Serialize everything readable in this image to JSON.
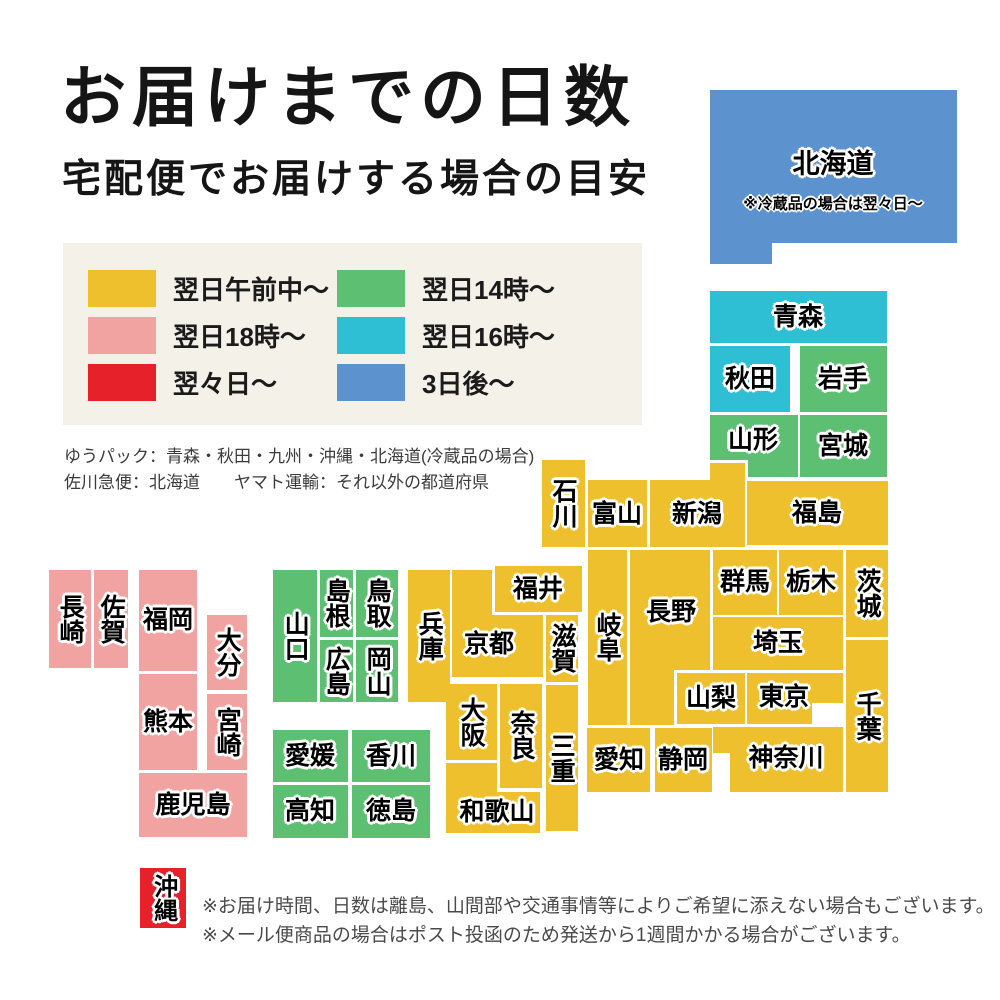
{
  "title": "お届けまでの日数",
  "subtitle": "宅配便でお届けする場合の目安",
  "legend": {
    "items": [
      {
        "label": "翌日午前中〜",
        "color": "yellow"
      },
      {
        "label": "翌日18時〜",
        "color": "pink"
      },
      {
        "label": "翌々日〜",
        "color": "red"
      },
      {
        "label": "翌日14時〜",
        "color": "green"
      },
      {
        "label": "翌日16時〜",
        "color": "cyan"
      },
      {
        "label": "3日後〜",
        "color": "blue"
      }
    ]
  },
  "carrier_notes": [
    "ゆうパック：青森・秋田・九州・沖縄・北海道(冷蔵品の場合)",
    "佐川急便：北海道　　ヤマト運輸：それ以外の都道府県"
  ],
  "footer": {
    "notes": [
      "※お届け時間、日数は離島、山間部や交通事情等によりご希望に添えない場合もございます。",
      "※メール便商品の場合はポスト投函のため発送から1週間かかる場合がございます。"
    ]
  },
  "map": {
    "palette": {
      "yellow": "#efc02e",
      "pink": "#f0a3a0",
      "red": "#e62129",
      "green": "#5cbf72",
      "cyan": "#2ebfd5",
      "blue": "#5c93cf"
    },
    "prefectures": [
      {
        "id": "hokkaido",
        "name": "北海道",
        "color": "blue",
        "fs": 27,
        "label": [
          833,
          164
        ],
        "rects": [
          [
            710,
            90,
            247,
            153
          ],
          [
            710,
            243,
            62,
            21
          ]
        ],
        "note": {
          "text": "※冷蔵品の場合は翌々日〜",
          "cx": 833,
          "cy": 203
        }
      },
      {
        "id": "aomori",
        "name": "青森",
        "color": "cyan",
        "label": [
          798,
          317
        ],
        "rects": [
          [
            710,
            291,
            177,
            52
          ]
        ]
      },
      {
        "id": "akita",
        "name": "秋田",
        "color": "cyan",
        "label": [
          750,
          379
        ],
        "rects": [
          [
            710,
            346,
            80,
            66
          ]
        ]
      },
      {
        "id": "iwate",
        "name": "岩手",
        "color": "green",
        "label": [
          843,
          379
        ],
        "rects": [
          [
            800,
            346,
            87,
            66
          ]
        ]
      },
      {
        "id": "yamagata",
        "name": "山形",
        "color": "green",
        "label": [
          753,
          440
        ],
        "rects": [
          [
            710,
            415,
            88,
            45
          ],
          [
            748,
            460,
            50,
            17
          ]
        ]
      },
      {
        "id": "miyagi",
        "name": "宮城",
        "color": "green",
        "label": [
          843,
          446
        ],
        "rects": [
          [
            800,
            415,
            87,
            62
          ]
        ]
      },
      {
        "id": "fukushima",
        "name": "福島",
        "color": "yellow",
        "label": [
          817,
          513
        ],
        "rects": [
          [
            747,
            481,
            141,
            64
          ]
        ]
      },
      {
        "id": "niigata",
        "name": "新潟",
        "color": "yellow",
        "label": [
          697,
          514
        ],
        "rects": [
          [
            650,
            480,
            95,
            67
          ],
          [
            710,
            463,
            35,
            17
          ]
        ]
      },
      {
        "id": "toyama",
        "name": "富山",
        "color": "yellow",
        "label": [
          617,
          514
        ],
        "rects": [
          [
            588,
            480,
            59,
            67
          ]
        ]
      },
      {
        "id": "ishikawa",
        "name": "石川",
        "color": "yellow",
        "v": true,
        "label": [
          563,
          503
        ],
        "rects": [
          [
            542,
            460,
            43,
            87
          ]
        ]
      },
      {
        "id": "gunma",
        "name": "群馬",
        "color": "yellow",
        "label": [
          745,
          582
        ],
        "rects": [
          [
            713,
            550,
            64,
            65
          ]
        ]
      },
      {
        "id": "tochigi",
        "name": "栃木",
        "color": "yellow",
        "label": [
          811,
          582
        ],
        "rects": [
          [
            779,
            550,
            64,
            65
          ]
        ]
      },
      {
        "id": "ibaraki",
        "name": "茨城",
        "color": "yellow",
        "v": true,
        "label": [
          867,
          593
        ],
        "rects": [
          [
            846,
            550,
            42,
            87
          ]
        ]
      },
      {
        "id": "saitama",
        "name": "埼玉",
        "color": "yellow",
        "label": [
          778,
          643
        ],
        "rects": [
          [
            713,
            617,
            130,
            53
          ]
        ]
      },
      {
        "id": "nagano",
        "name": "長野",
        "color": "yellow",
        "label": [
          671,
          612
        ],
        "rects": [
          [
            630,
            550,
            80,
            120
          ],
          [
            630,
            670,
            44,
            55
          ]
        ]
      },
      {
        "id": "gifu",
        "name": "岐阜",
        "color": "yellow",
        "v": true,
        "label": [
          607,
          637
        ],
        "rects": [
          [
            588,
            550,
            39,
            175
          ]
        ]
      },
      {
        "id": "yamanashi",
        "name": "山梨",
        "color": "yellow",
        "label": [
          711,
          698
        ],
        "rects": [
          [
            677,
            673,
            68,
            51
          ]
        ]
      },
      {
        "id": "tokyo",
        "name": "東京",
        "color": "yellow",
        "label": [
          784,
          697
        ],
        "rects": [
          [
            747,
            673,
            96,
            30
          ],
          [
            747,
            703,
            65,
            21
          ]
        ]
      },
      {
        "id": "chiba",
        "name": "千葉",
        "color": "yellow",
        "v": true,
        "label": [
          867,
          716
        ],
        "rects": [
          [
            846,
            640,
            42,
            152
          ]
        ]
      },
      {
        "id": "kanagawa",
        "name": "神奈川",
        "color": "yellow",
        "label": [
          786,
          758
        ],
        "rects": [
          [
            713,
            727,
            130,
            26
          ],
          [
            730,
            753,
            113,
            39
          ]
        ]
      },
      {
        "id": "shizuoka",
        "name": "静岡",
        "color": "yellow",
        "label": [
          683,
          760
        ],
        "rects": [
          [
            655,
            728,
            57,
            64
          ]
        ]
      },
      {
        "id": "aichi",
        "name": "愛知",
        "color": "yellow",
        "label": [
          619,
          760
        ],
        "rects": [
          [
            587,
            728,
            63,
            64
          ]
        ]
      },
      {
        "id": "kyoto",
        "name": "京都",
        "color": "yellow",
        "label": [
          489,
          644
        ],
        "rects": [
          [
            452,
            570,
            91,
            107
          ]
        ]
      },
      {
        "id": "fukui",
        "name": "福井",
        "color": "yellow",
        "ring": true,
        "label": [
          538,
          589
        ],
        "rects": [
          [
            495,
            566,
            87,
            46
          ]
        ]
      },
      {
        "id": "shiga",
        "name": "滋賀",
        "color": "yellow",
        "v": true,
        "label": [
          562,
          648
        ],
        "rects": [
          [
            546,
            615,
            32,
            67
          ]
        ]
      },
      {
        "id": "osaka",
        "name": "大阪",
        "color": "yellow",
        "v": true,
        "label": [
          471,
          722
        ],
        "rects": [
          [
            446,
            684,
            51,
            76
          ]
        ]
      },
      {
        "id": "nara",
        "name": "奈良",
        "color": "yellow",
        "v": true,
        "label": [
          521,
          735
        ],
        "rects": [
          [
            500,
            684,
            42,
            104
          ]
        ]
      },
      {
        "id": "mie",
        "name": "三重",
        "color": "yellow",
        "v": true,
        "label": [
          561,
          758
        ],
        "rects": [
          [
            546,
            685,
            32,
            146
          ]
        ]
      },
      {
        "id": "wakayama",
        "name": "和歌山",
        "color": "yellow",
        "label": [
          497,
          812
        ],
        "rects": [
          [
            446,
            763,
            51,
            70
          ],
          [
            497,
            792,
            43,
            41
          ]
        ]
      },
      {
        "id": "hyogo",
        "name": "兵庫",
        "color": "yellow",
        "v": true,
        "label": [
          429,
          636
        ],
        "rects": [
          [
            408,
            570,
            42,
            132
          ]
        ]
      },
      {
        "id": "tottori",
        "name": "鳥取",
        "color": "green",
        "v": true,
        "label": [
          377,
          603
        ],
        "rects": [
          [
            356,
            570,
            42,
            67
          ]
        ]
      },
      {
        "id": "okayama",
        "name": "岡山",
        "color": "green",
        "v": true,
        "label": [
          377,
          671
        ],
        "rects": [
          [
            356,
            640,
            42,
            62
          ]
        ]
      },
      {
        "id": "shimane",
        "name": "島根",
        "color": "green",
        "v": true,
        "label": [
          336,
          603
        ],
        "rects": [
          [
            320,
            570,
            33,
            67
          ]
        ]
      },
      {
        "id": "hiroshima",
        "name": "広島",
        "color": "green",
        "v": true,
        "label": [
          336,
          671
        ],
        "rects": [
          [
            320,
            640,
            33,
            62
          ]
        ]
      },
      {
        "id": "yamaguchi",
        "name": "山口",
        "color": "green",
        "v": true,
        "label": [
          295,
          636
        ],
        "rects": [
          [
            273,
            570,
            44,
            132
          ]
        ]
      },
      {
        "id": "ehime",
        "name": "愛媛",
        "color": "green",
        "label": [
          310,
          756
        ],
        "rects": [
          [
            273,
            730,
            75,
            52
          ]
        ]
      },
      {
        "id": "kagawa",
        "name": "香川",
        "color": "green",
        "label": [
          391,
          756
        ],
        "rects": [
          [
            352,
            730,
            78,
            52
          ]
        ]
      },
      {
        "id": "kochi",
        "name": "高知",
        "color": "green",
        "label": [
          310,
          811
        ],
        "rects": [
          [
            273,
            785,
            75,
            53
          ]
        ]
      },
      {
        "id": "tokushima",
        "name": "徳島",
        "color": "green",
        "label": [
          391,
          811
        ],
        "rects": [
          [
            352,
            785,
            78,
            53
          ]
        ]
      },
      {
        "id": "fukuoka",
        "name": "福岡",
        "color": "pink",
        "label": [
          168,
          620
        ],
        "rects": [
          [
            139,
            570,
            58,
            101
          ]
        ]
      },
      {
        "id": "saga",
        "name": "佐賀",
        "color": "pink",
        "v": true,
        "label": [
          111,
          619
        ],
        "rects": [
          [
            94,
            570,
            34,
            98
          ]
        ]
      },
      {
        "id": "nagasaki",
        "name": "長崎",
        "color": "pink",
        "v": true,
        "label": [
          70,
          619
        ],
        "rects": [
          [
            49,
            570,
            42,
            98
          ]
        ]
      },
      {
        "id": "oita",
        "name": "大分",
        "color": "pink",
        "v": true,
        "label": [
          227,
          652
        ],
        "rects": [
          [
            207,
            615,
            40,
            75
          ]
        ]
      },
      {
        "id": "kumamoto",
        "name": "熊本",
        "color": "pink",
        "label": [
          168,
          722
        ],
        "rects": [
          [
            139,
            674,
            58,
            96
          ]
        ]
      },
      {
        "id": "miyazaki",
        "name": "宮崎",
        "color": "pink",
        "v": true,
        "label": [
          227,
          732
        ],
        "rects": [
          [
            207,
            694,
            40,
            76
          ]
        ]
      },
      {
        "id": "kagoshima",
        "name": "鹿児島",
        "color": "pink",
        "label": [
          193,
          805
        ],
        "rects": [
          [
            139,
            773,
            108,
            64
          ]
        ]
      },
      {
        "id": "okinawa",
        "name": "沖縄",
        "color": "red",
        "v": true,
        "fs": 24,
        "label": [
          163,
          898
        ],
        "rects": [
          [
            140,
            868,
            46,
            60
          ]
        ]
      }
    ]
  }
}
